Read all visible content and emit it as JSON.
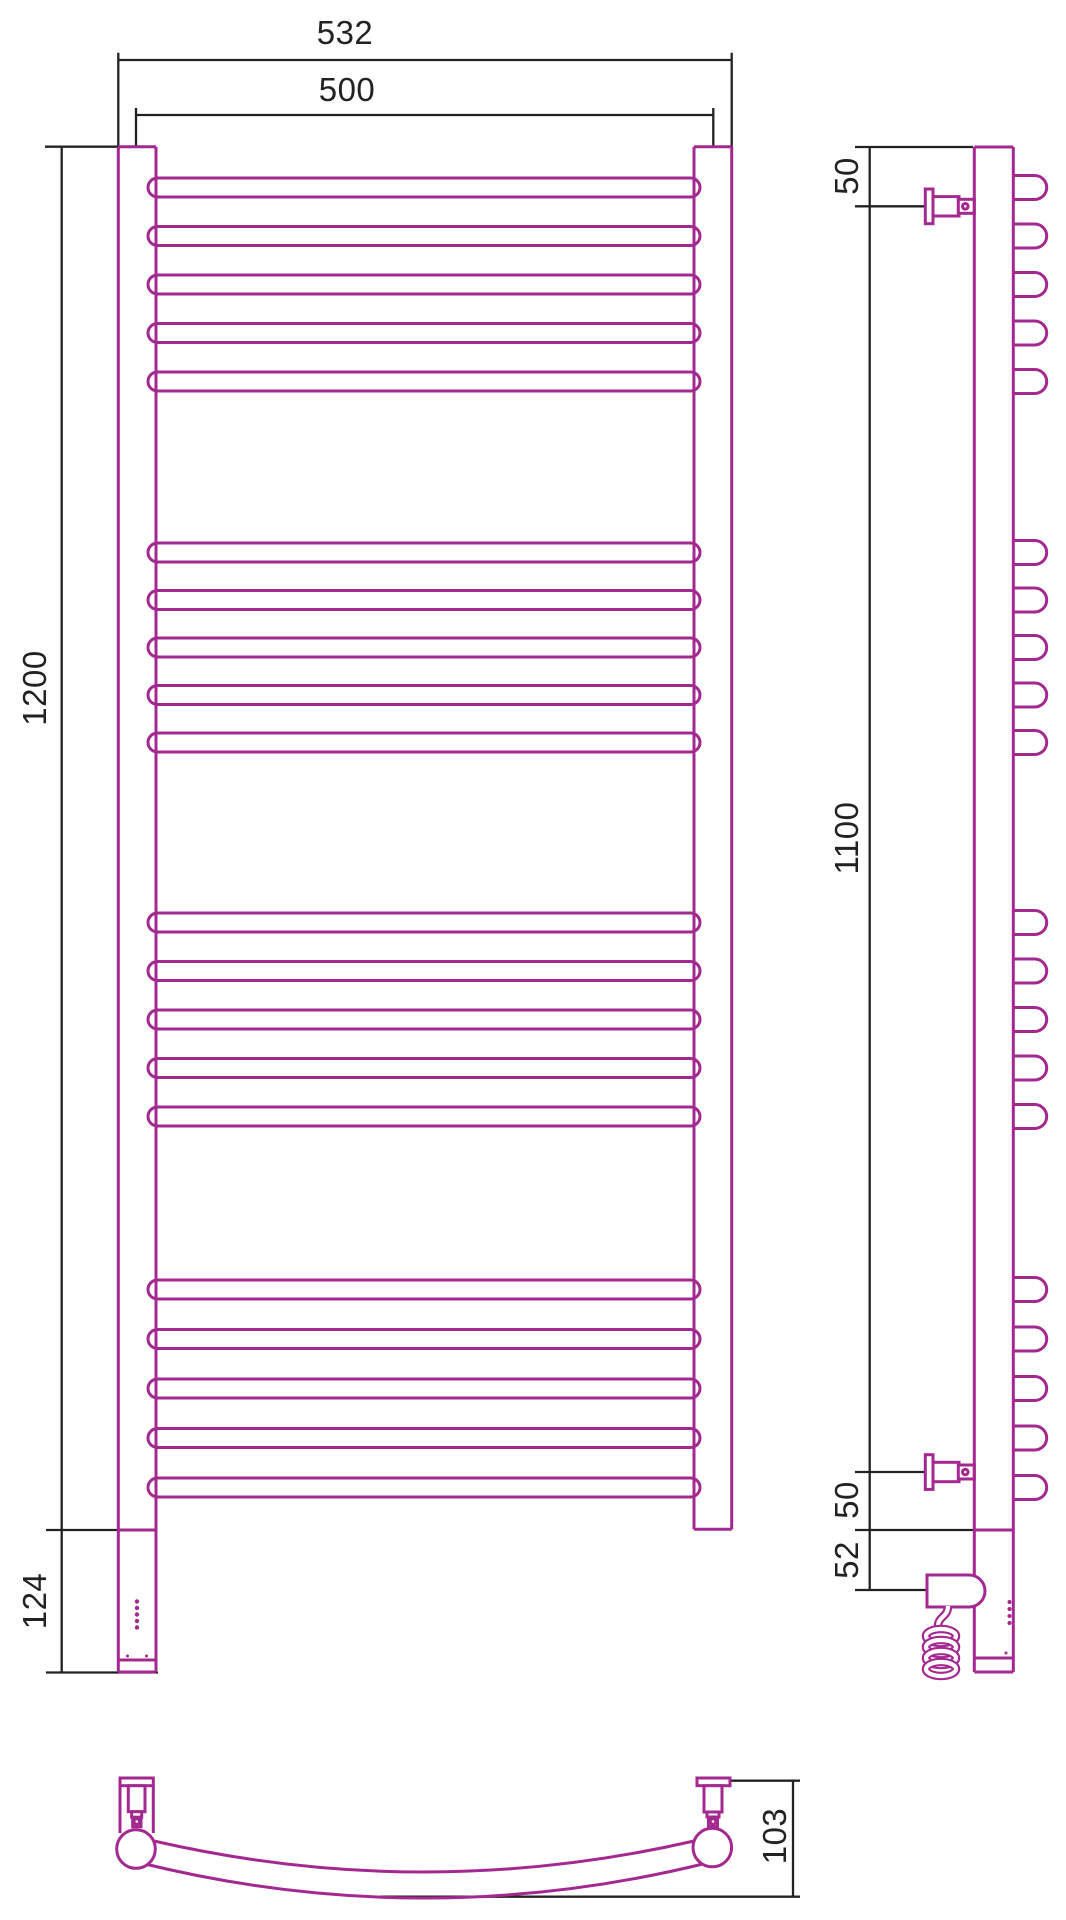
{
  "document": {
    "title": "Curved ladder towel rail - dimensional drawing",
    "views_shown": [
      "front view",
      "side view",
      "top view"
    ]
  },
  "colors": {
    "product_outline": "#A3288F",
    "dimension_lines": "#222222",
    "background": "#FFFFFF"
  },
  "dimension_labels": {
    "front_overall_width": "532",
    "front_axis_width": "500",
    "front_height": "1200",
    "front_lower_section": "124",
    "side_top_bracket_offset": "50",
    "side_bracket_span": "1100",
    "side_bottom_bracket_offset": "50",
    "side_element_offset": "52",
    "top_depth": "103"
  },
  "views": {
    "front": {
      "tubes": {
        "left_x1": 118.3,
        "left_x2": 156,
        "right_x1": 694,
        "right_x2": 731.7,
        "top": 146.7,
        "right_bottom": 1529.3,
        "joint": 1530,
        "cap": 1660,
        "bottom": 1672
      },
      "rungs": {
        "x1": 148,
        "x2": 700,
        "height": 19,
        "tops": [
          178,
          226.5,
          275,
          323.5,
          372,
          543,
          590.5,
          638,
          685.5,
          733,
          913,
          961.5,
          1010,
          1058.5,
          1107,
          1280,
          1329.5,
          1379,
          1428.5,
          1478
        ]
      },
      "leds": {
        "x": 137,
        "ys": [
          1601.5,
          1608,
          1614.5,
          1621,
          1627.5
        ],
        "r": 2.2,
        "pair_y": 1656,
        "pair_xs": [
          127.5,
          146.5
        ],
        "pair_r": 1.5
      }
    },
    "side": {
      "tube": {
        "x1": 974.3,
        "x2": 1013.3,
        "top": 147,
        "joint": 1530,
        "cap": 1658,
        "bottom": 1672
      },
      "rung_ends": {
        "x2": 1046.7,
        "height": 24
      },
      "brackets": {
        "cys": [
          206.3,
          1472
        ]
      },
      "element": {
        "x1": 927,
        "x2": 985,
        "y1": 1575,
        "y2": 1607
      },
      "cable": {
        "neck": "M 948 1606 C 948 1618 937 1616 938 1628",
        "coil_cx": 941,
        "coil_rx": 15,
        "coil_ry": 7,
        "coil_cys": [
          1636,
          1647,
          1658,
          1669
        ]
      },
      "leds": {
        "x": 1009.5,
        "ys": [
          1602,
          1609,
          1616,
          1623
        ],
        "r": 2,
        "dot": [
          1006,
          1653
        ],
        "dot_r": 1.5
      }
    },
    "bottom": {
      "ends": [
        {
          "cx": 136,
          "cy": 1849,
          "r": 19.3
        },
        {
          "cx": 712.3,
          "cy": 1847.5,
          "r": 19.3
        }
      ],
      "upper_arc": "M 154 1841 Q 424 1903 694 1841",
      "lower_arc": "M 141 1863 Q 424 1933 707 1863"
    }
  }
}
